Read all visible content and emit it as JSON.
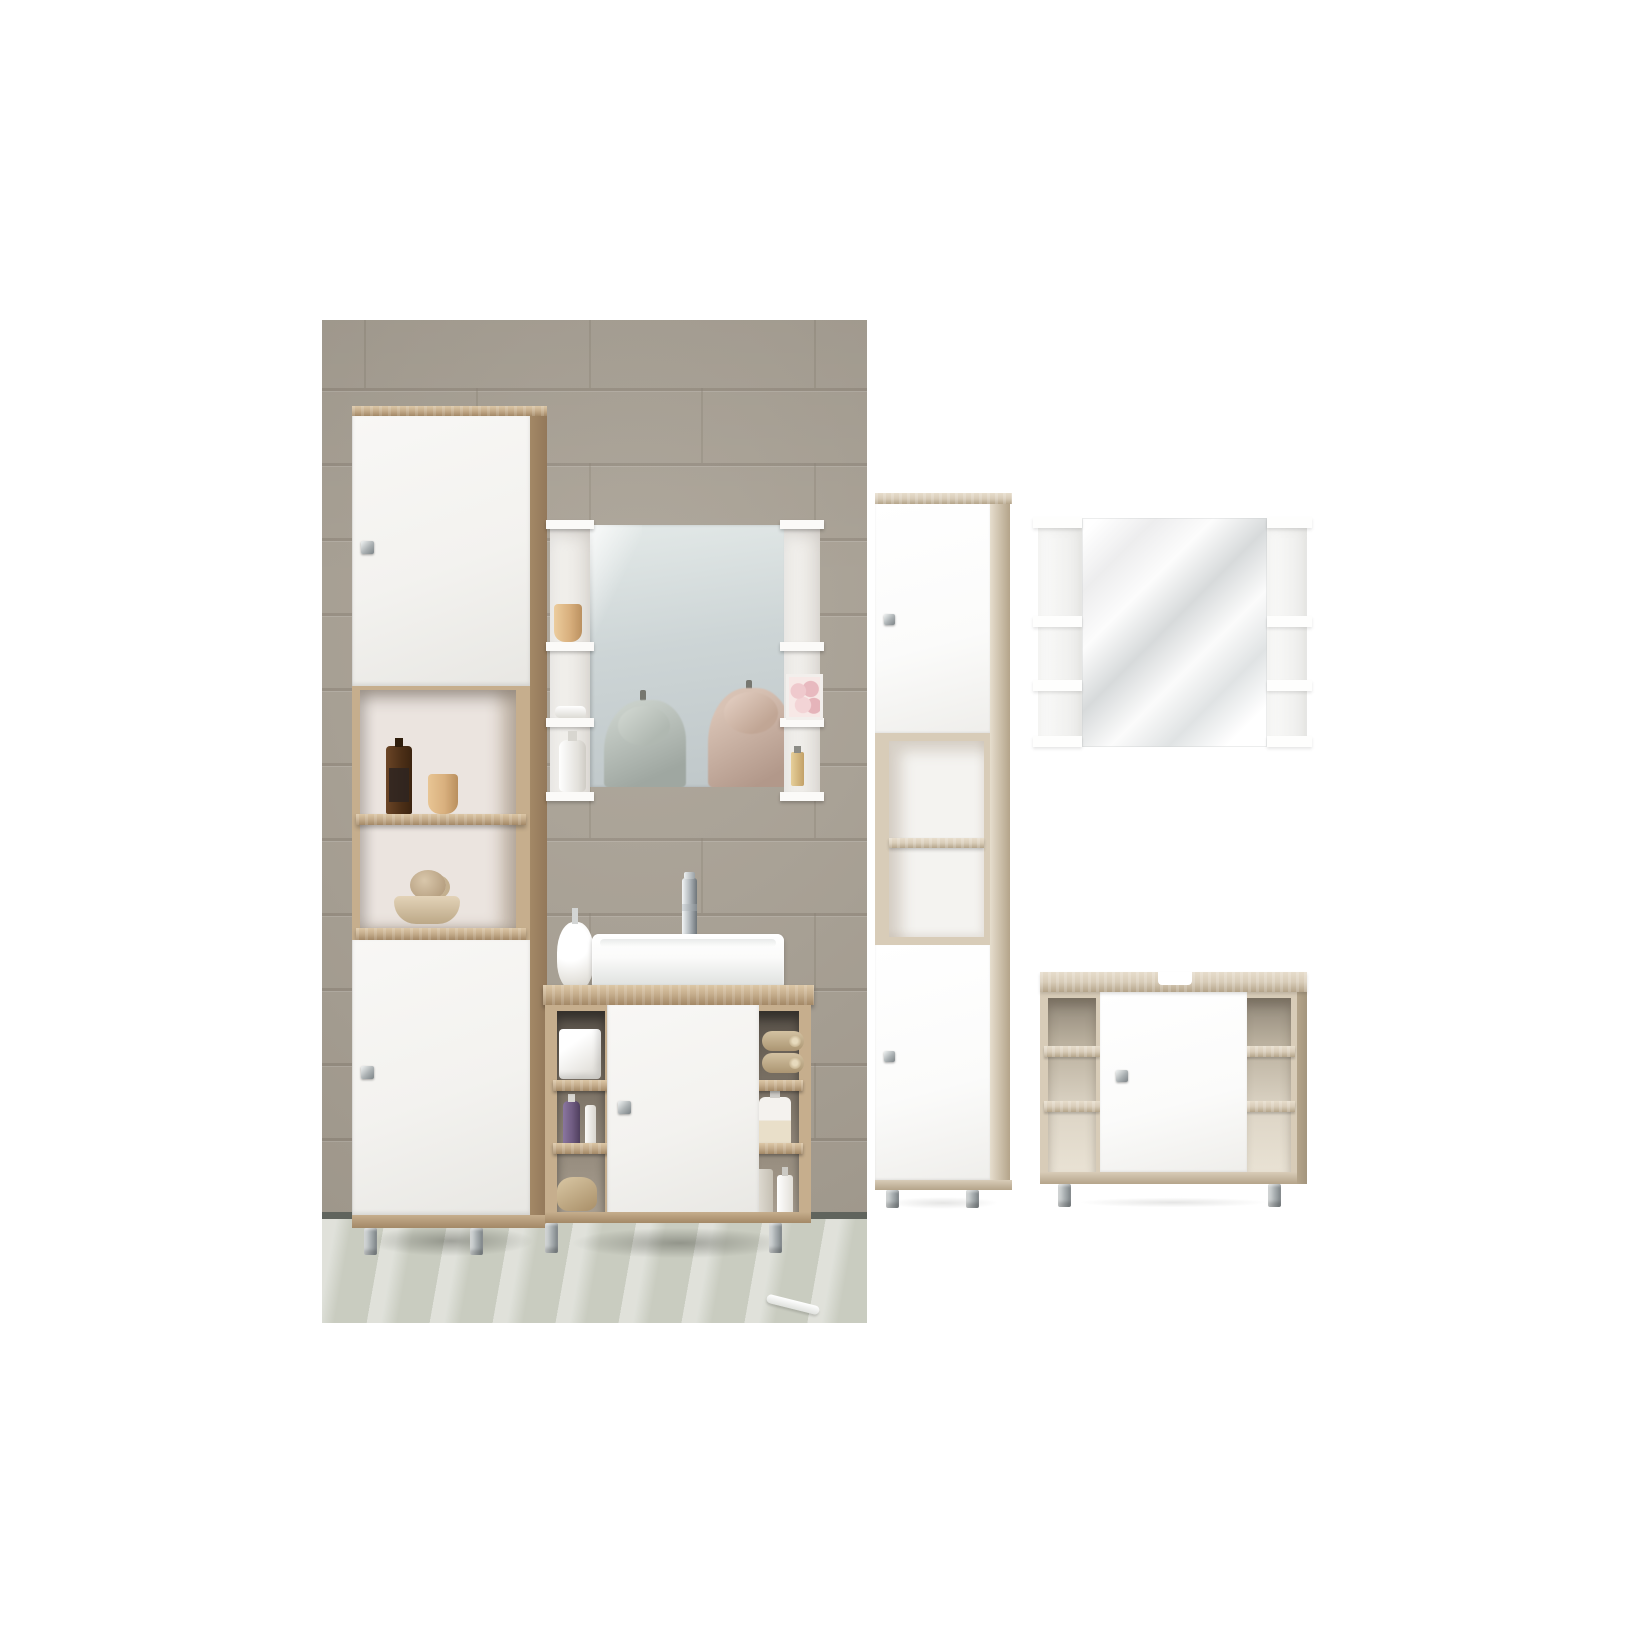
{
  "meta": {
    "type": "product-image-composite",
    "subject": "3-piece bathroom furniture set (tall cabinet, wall mirror with side shelves, under-sink vanity) shown in a lifestyle photo on the left and as isolated renders on white on the right"
  },
  "colors": {
    "canvas": "#ffffff",
    "wall": "#a8a093",
    "grout": "#877e71",
    "skirting": "#60645d",
    "floor": "#c9ccc0",
    "oak": "#c6ae8d",
    "oak_hi": "#dcc7a6",
    "oak_lo": "#a38866",
    "oak_render": "#d8ccb8",
    "oak_render_hi": "#e7ddcc",
    "oak_render_lo": "#b4a48a",
    "front_white": "#f3f2ef",
    "front_white_render": "#fbfbfa",
    "interior": "#ebe4df",
    "interior_render": "#f4f3f0",
    "metal_hi": "#e5e8e8",
    "metal": "#aab0b2",
    "metal_lo": "#7d8487",
    "mirror_top": "#e3e9e8",
    "mirror_bottom": "#bfc7c9",
    "robe_gray_hi": "#c8cfc9",
    "robe_gray_lo": "#9fa7a1",
    "robe_pink_hi": "#d8c2b4",
    "robe_pink_lo": "#b2988a",
    "glass_gray": "#d7dadb",
    "beige": "#d9b07e",
    "purple": "#6f5b81",
    "shadow_photo": "rgba(58,60,52,0.38)",
    "shadow_render": "rgba(110,110,105,0.18)"
  },
  "photo_scene": {
    "name": "bathroom-lifestyle-photo",
    "wall": {
      "width": 545,
      "height": 892,
      "tile_width": 225,
      "tile_height": 75,
      "first_line_y": -7,
      "base_offset": 42,
      "row_offset": 112
    },
    "furniture": [
      "tall-cabinet",
      "mirror-shelf-unit",
      "under-sink-vanity"
    ],
    "props": [
      "amber-glass-bottle",
      "ceramic-cup",
      "twig-decor-ball",
      "decor-bowl",
      "ceramic-cup-small",
      "soap-dish",
      "lotion-pump-bottle",
      "flower-gift-box",
      "perfume-bottle",
      "soap-dispenser",
      "vessel-basin",
      "chrome-faucet",
      "tissue-box",
      "purple-cosmetic-bottle",
      "cosmetic-tube",
      "wooden-brush",
      "rolled-towels",
      "soap-pump-bottle",
      "clear-bottles",
      "toothbrush-on-floor",
      "hanging-robe-gray-reflection",
      "hanging-robe-pink-reflection"
    ]
  },
  "render_scene": {
    "name": "isolated-product-renders",
    "items": [
      "tall-cabinet-render",
      "mirror-with-shelves-render",
      "under-sink-vanity-render"
    ],
    "details": [
      "white doors with square metal knobs",
      "sonoma oak carcass",
      "open cubby shelves",
      "round metal feet",
      "siphon cutout in vanity top"
    ]
  }
}
